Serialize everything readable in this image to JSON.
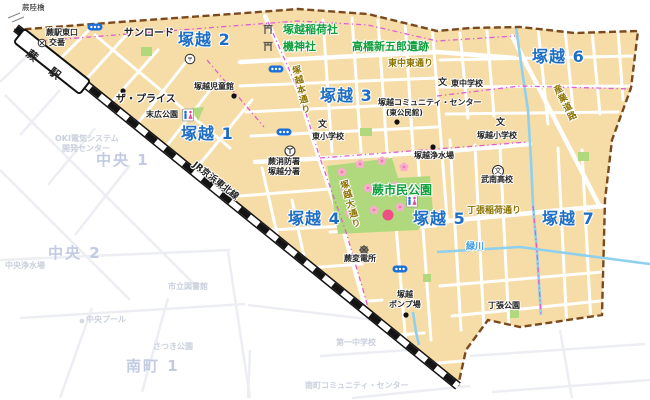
{
  "area_labels": {
    "t1": "塚越 1",
    "t2": "塚越 2",
    "t3": "塚越 3",
    "t4": "塚越 4",
    "t5": "塚越 5",
    "t6": "塚越 6",
    "t7": "塚越 7"
  },
  "shrines": {
    "inari": "塚越稲荷社",
    "hata": "機神社",
    "takahashi": "高橋新五郎遺跡",
    "citizen_park": "蕨市民公園"
  },
  "pois": {
    "rikkyo": "蕨陸橋",
    "station_exit": "蕨駅東口",
    "koban": "交番",
    "sunroad": "サンロード",
    "the_price": "ザ・プライス",
    "jidokan": "塚越児童館",
    "suehiro": "末広公園",
    "fire1": "蕨消防署",
    "fire2": "塚越分署",
    "higashi_elem": "東小学校",
    "higashi_jhs": "東中学校",
    "community1": "塚越コミュニティ・センター",
    "community2": "(東公民館)",
    "tsuka_elem": "塚越小学校",
    "josui": "塚越浄水場",
    "bunan": "武南高校",
    "substation": "蕨変電所",
    "pump1": "塚越",
    "pump2": "ポンプ場",
    "chohari_park": "丁張公園"
  },
  "roads": {
    "honmichi": "塚越本通り",
    "odori": "塚越大通り",
    "sangyo": "産業道路",
    "higashinaka": "東中東通り",
    "chohari_inari": "丁張稲荷通り"
  },
  "river": {
    "midorikawa": "緑川"
  },
  "rail": {
    "line": "JR京浜東北線",
    "station": "蕨 駅"
  },
  "icons": {
    "school": "文",
    "post": "〒"
  },
  "faded": {
    "oki1": "OKI電気システム",
    "oki2": "開発センター",
    "chuo1": "中央 1",
    "chuo2": "中央 2",
    "chuo_josui": "中央浄水場",
    "chuo_pool": "中央プール",
    "library": "市立図書館",
    "satsuki": "さつき公園",
    "minami1": "南町 1",
    "daiichi": "第一中学校",
    "minami_cc": "南町コミュニティ・センター"
  },
  "colors": {
    "district_fill": "#F6DCA6",
    "street": "#FFFFFF",
    "park_green": "#AFD97C",
    "boundary_brown": "#7A4A1E",
    "chome_magenta": "#E05FD0",
    "district_label_blue": "#1E6FC4",
    "shrine_label_green": "#0FA03C",
    "road_label_olive": "#8B7300",
    "stream_blue": "#8FD0EE",
    "railway_black": "#1A1A1A",
    "traffic_light_blue": "#1B6FD8",
    "blossom_pink": "#F7AECB"
  }
}
